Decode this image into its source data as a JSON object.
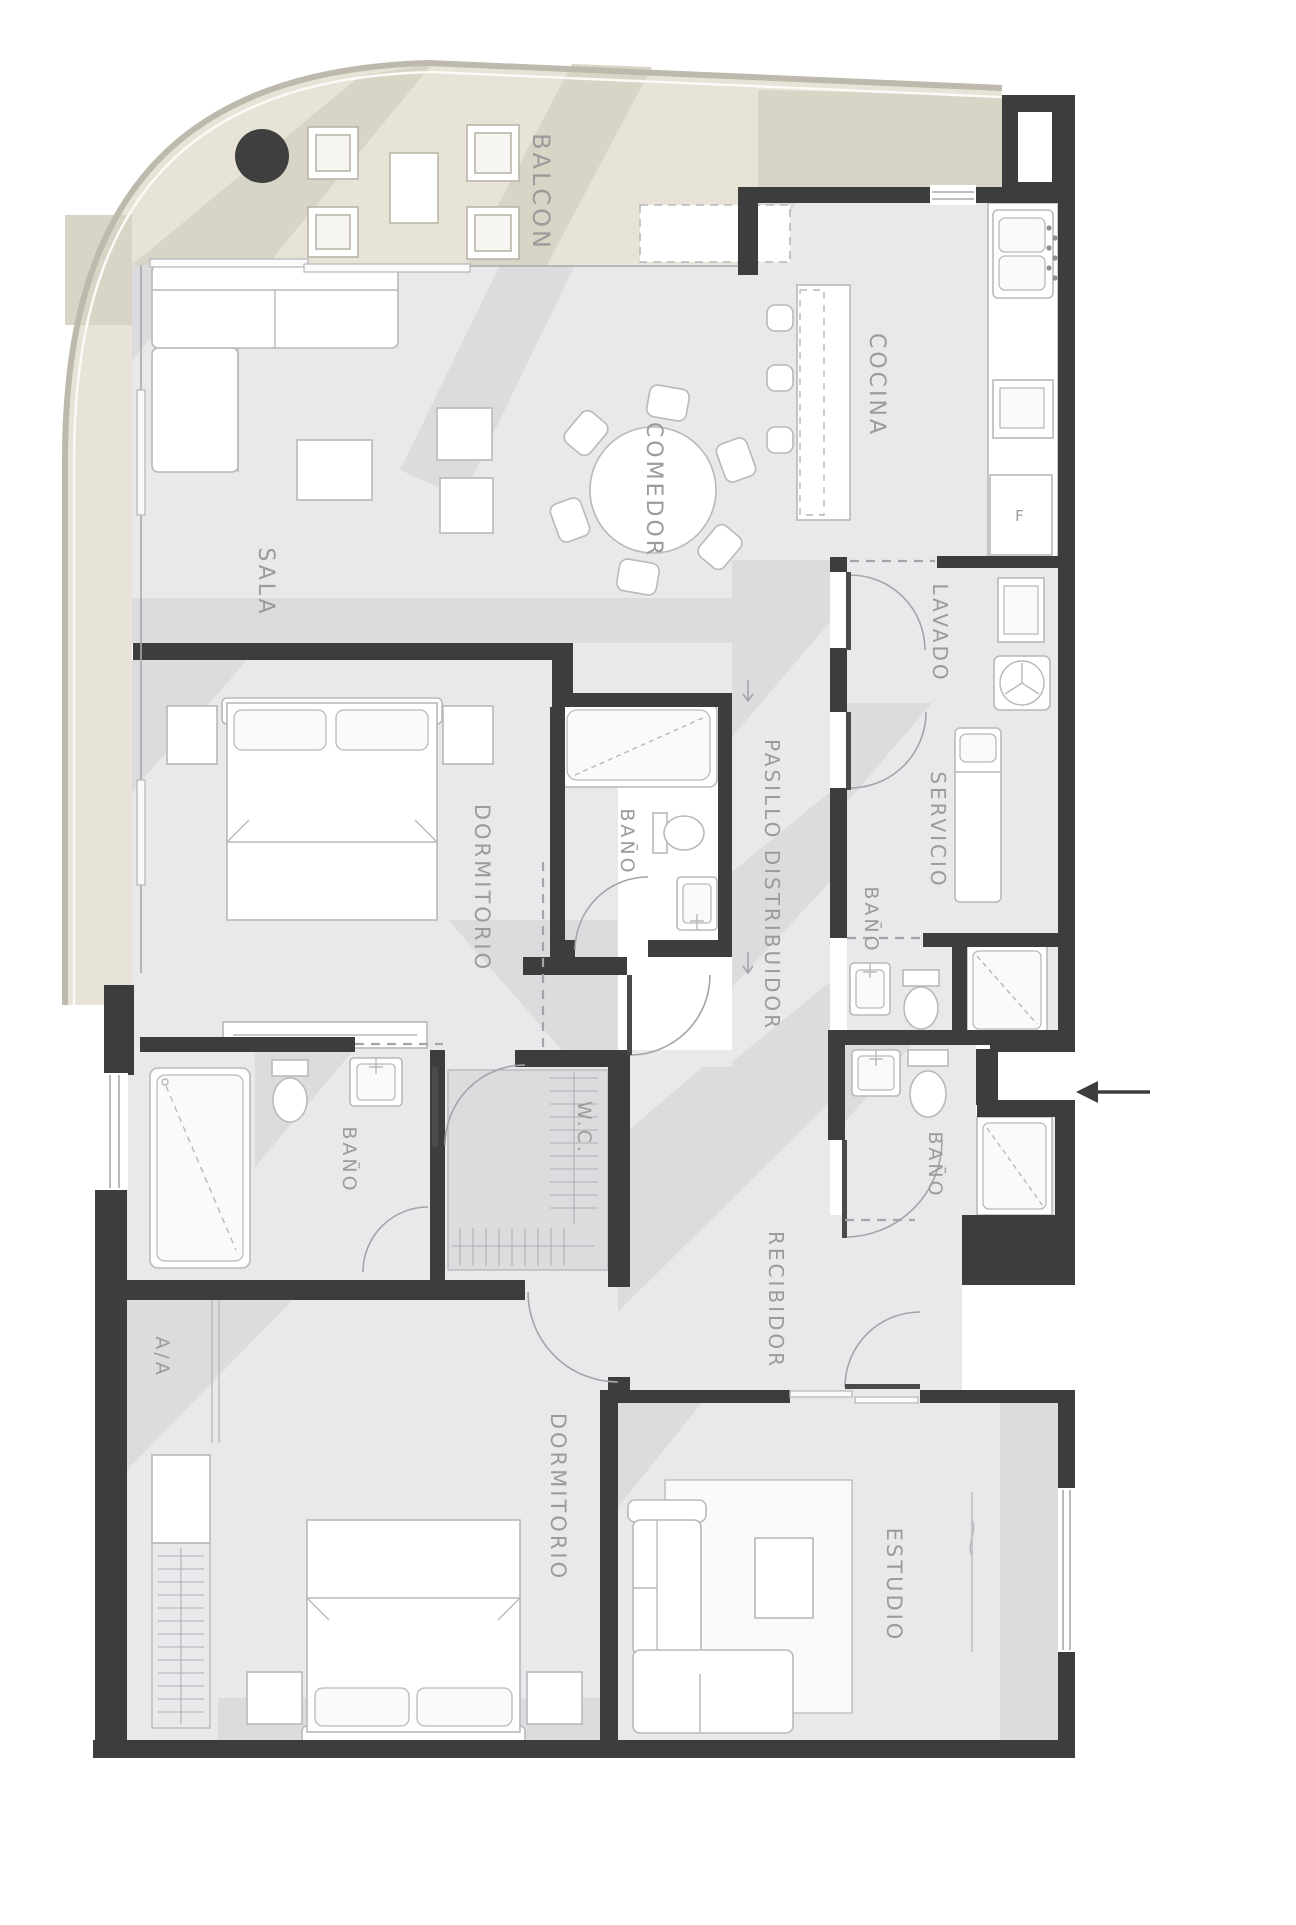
{
  "title": "Plano arquitectonico de apartamento",
  "colors": {
    "wall": "#3d3d3d",
    "floor": "#e9e9eb",
    "floor_shadow": "#dcdcdf",
    "balcony": "#e7e3d6",
    "balcony_shadow": "#d8d4c6",
    "rim": "#bdb9ac",
    "line": "#b9b9bd",
    "door": "#a4a4a9",
    "label": "#9b9b9b"
  },
  "rooms": {
    "balcon": {
      "label": "BALCON"
    },
    "cocina": {
      "label": "COCINA"
    },
    "comedor": {
      "label": "COMEDOR"
    },
    "sala": {
      "label": "SALA"
    },
    "lavado": {
      "label": "LAVADO"
    },
    "servicio": {
      "label": "SERVICIO"
    },
    "bano_servicio": {
      "label": "BAÑO"
    },
    "bano_guest": {
      "label": "BAÑO"
    },
    "bano_dorm1": {
      "label": "BAÑO"
    },
    "bano_master": {
      "label": "BAÑO"
    },
    "dormitorio1": {
      "label": "DORMITORIO"
    },
    "dormitorio2": {
      "label": "DORMITORIO"
    },
    "pasillo": {
      "label": "PASILLO DISTRIBUIDOR"
    },
    "wc": {
      "label": "W.C."
    },
    "recibidor": {
      "label": "RECIBIDOR"
    },
    "aa": {
      "label": "A/A"
    },
    "estudio": {
      "label": "ESTUDIO"
    }
  },
  "appliances": {
    "fridge_label": "F"
  }
}
